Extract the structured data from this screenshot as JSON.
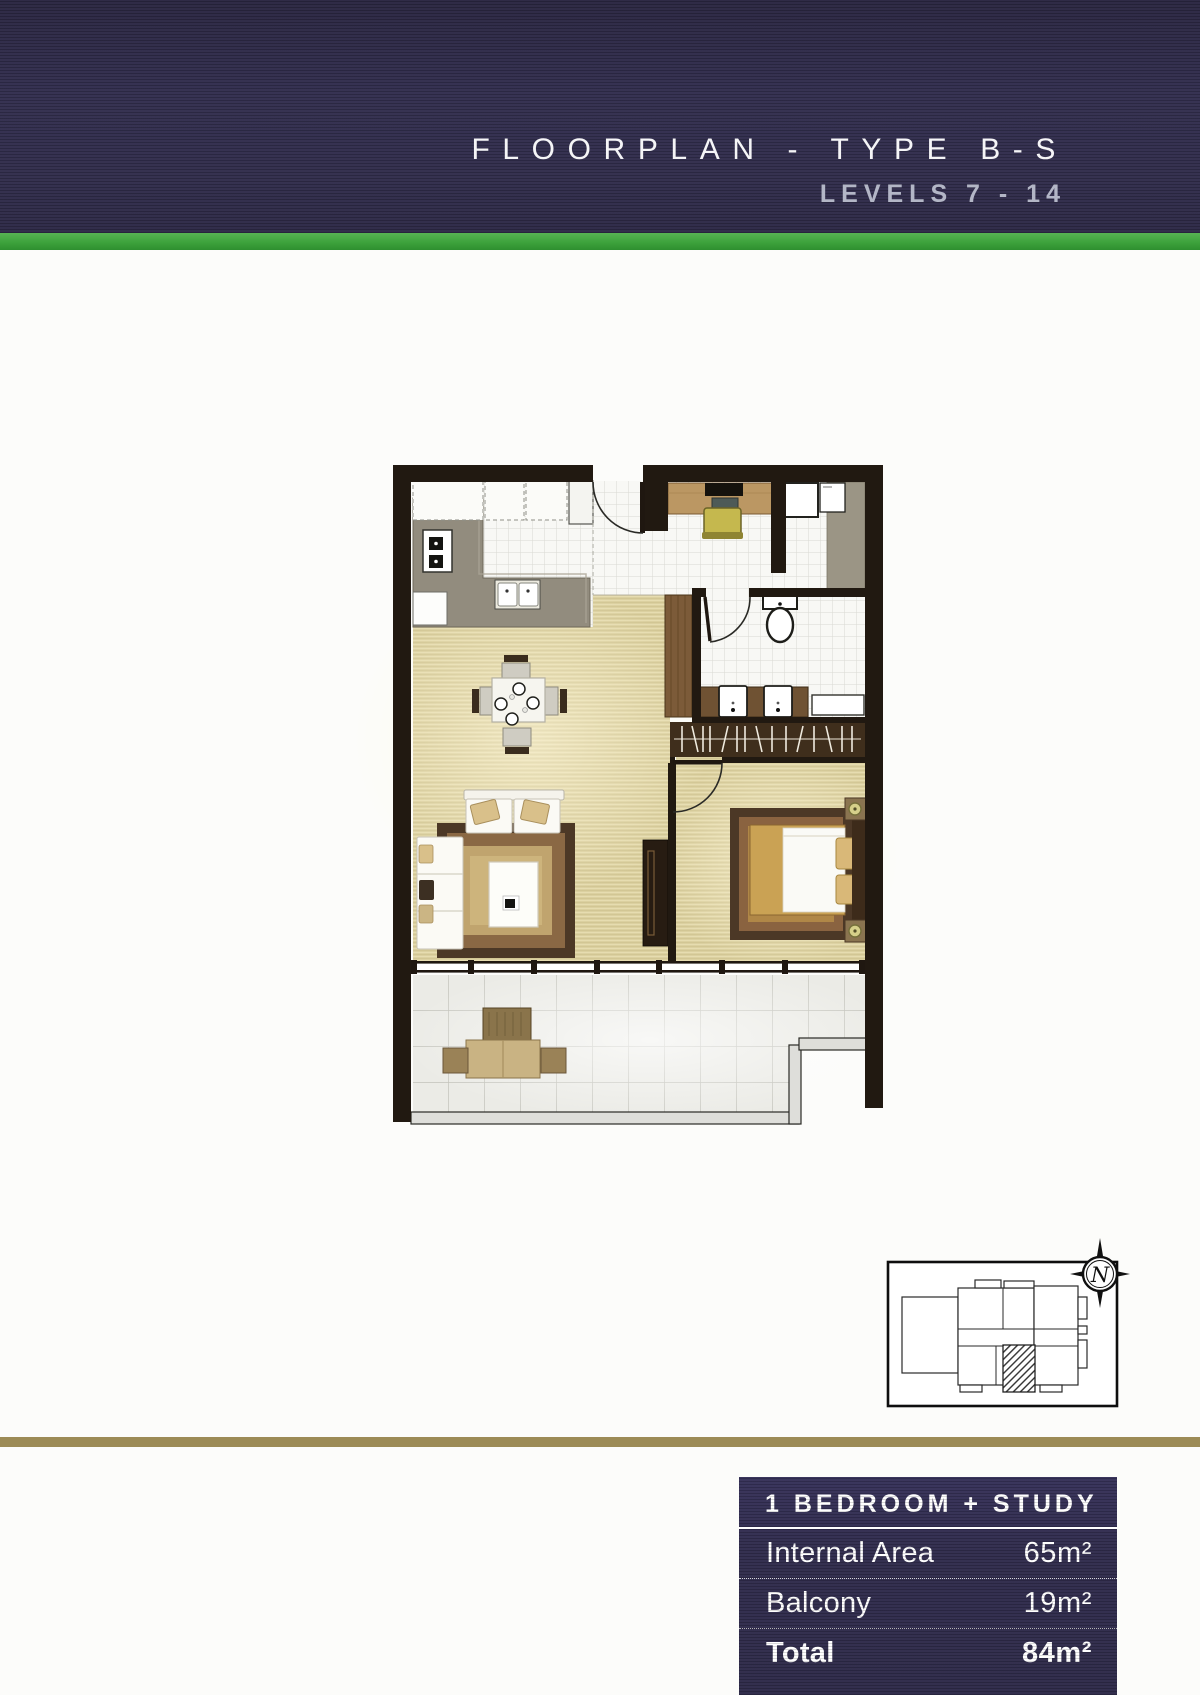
{
  "header": {
    "title": "FLOORPLAN - TYPE B-S",
    "subtitle": "LEVELS 7 - 14"
  },
  "unit_table": {
    "header": "1 BEDROOM + STUDY",
    "rows": [
      {
        "label": "Internal Area",
        "value": "65m²"
      },
      {
        "label": "Balcony",
        "value": "19m²"
      },
      {
        "label": "Total",
        "value": "84m²"
      }
    ]
  },
  "key_plan": {
    "compass_letter": "N",
    "highlighted_unit": "hatched unit, centre-south of building footprint"
  },
  "palette": {
    "header_bg": "#322e4d",
    "green_stripe": "#3da23c",
    "gold_stripe": "#9c8b56",
    "table_bg": "#312d4e",
    "wall": "#211911",
    "floor_beige": "#dbd0a0",
    "tile_white": "#f8f8f5",
    "balcony_tile": "#ebebe6",
    "counter_gray": "#928c7e",
    "wood_brown": "#7c5b39",
    "rug_brown": "#4c3826",
    "bed_gold": "#caa254",
    "chair_olive": "#c5b84e"
  }
}
